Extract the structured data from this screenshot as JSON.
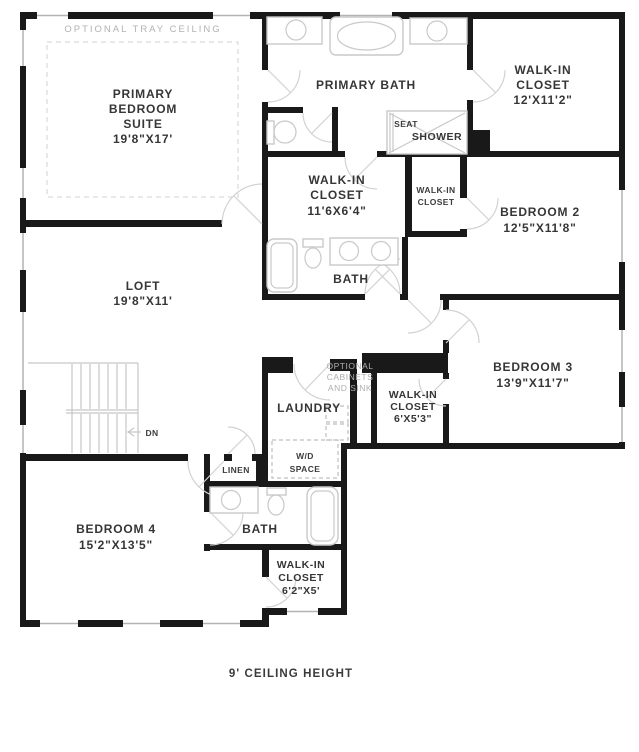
{
  "colors": {
    "wall": "#191919",
    "fixture_line": "#c9c9c9",
    "dashed_line": "#d9d9d9",
    "muted_text": "#aeaeae",
    "text": "#363636"
  },
  "labels": {
    "tray_ceiling": "OPTIONAL  TRAY CEILING",
    "primary_suite_1": "PRIMARY",
    "primary_suite_2": "BEDROOM",
    "primary_suite_3": "SUITE",
    "primary_suite_dim": "19'8\"X17'",
    "primary_bath": "PRIMARY BATH",
    "wic12_1": "WALK-IN",
    "wic12_2": "CLOSET",
    "wic12_dim": "12'X11'2\"",
    "seat": "SEAT",
    "shower": "SHOWER",
    "wic116_1": "WALK-IN",
    "wic116_2": "CLOSET",
    "wic116_dim": "11'6X6'4\"",
    "wic_small_1": "WALK-IN",
    "wic_small_2": "CLOSET",
    "bedroom2": "BEDROOM 2",
    "bedroom2_dim": "12'5\"X11'8\"",
    "bath_mid": "BATH",
    "loft": "LOFT",
    "loft_dim": "19'8\"X11'",
    "bedroom3": "BEDROOM 3",
    "bedroom3_dim": "13'9\"X11'7\"",
    "opt_cab_1": "OPTIONAL",
    "opt_cab_2": "CABINETS",
    "opt_cab_3": "AND SINK",
    "laundry": "LAUNDRY",
    "wic653_1": "WALK-IN",
    "wic653_2": "CLOSET",
    "wic653_dim": "6'X5'3\"",
    "wd_1": "W/D",
    "wd_2": "SPACE",
    "dn": "DN",
    "linen": "LINEN",
    "bedroom4": "BEDROOM 4",
    "bedroom4_dim": "15'2\"X13'5\"",
    "bath_btm": "BATH",
    "wic625_1": "WALK-IN",
    "wic625_2": "CLOSET",
    "wic625_dim": "6'2\"X5'",
    "footer_note": "9' CEILING HEIGHT"
  }
}
